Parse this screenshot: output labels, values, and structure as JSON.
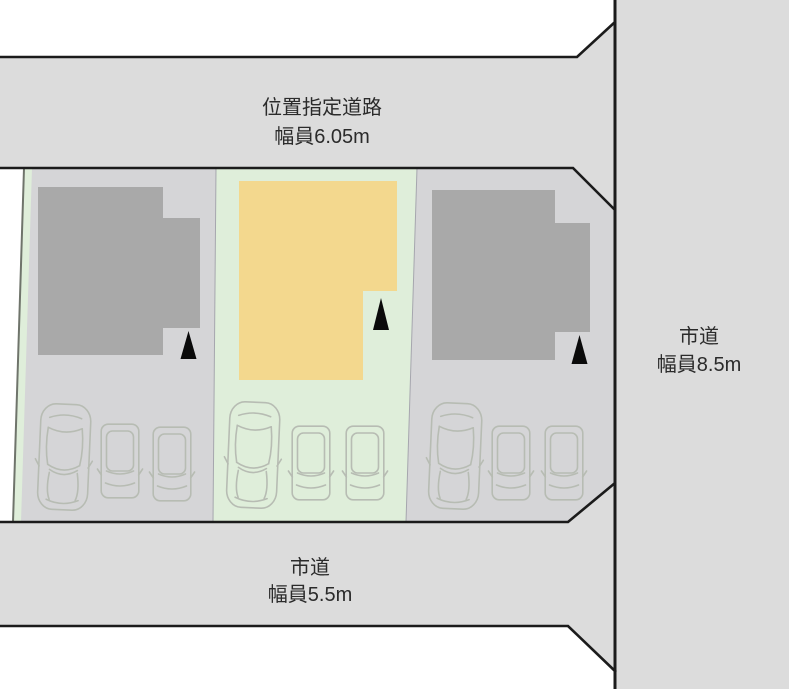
{
  "diagram": {
    "type": "residential-site-plan",
    "roads": {
      "top": {
        "name": "位置指定道路",
        "width_label": "幅員6.05m"
      },
      "right": {
        "name": "市道",
        "width_label": "幅員8.5m"
      },
      "bottom": {
        "name": "市道",
        "width_label": "幅員5.5m"
      }
    },
    "lots": {
      "count": 3,
      "subject_lot_position": "center",
      "parking_spaces_per_lot": 3,
      "entrance_markers_per_lot": 1
    },
    "icons": {
      "entrance_marker": "black-up-triangle",
      "large_car": "sedan-top-view-outline",
      "small_car": "compact-car-top-view-outline"
    },
    "colors": {
      "background": "#ffffff",
      "road": "#dcdcdc",
      "lot": "#d5d5d7",
      "subject_lot": "#dfeeda",
      "building": "#a9a9a9",
      "subject_building": "#f3d88e",
      "outline": "#1b1b1b",
      "car_outline": "#b7bcb3",
      "marker": "#0a0a0a",
      "label_text": "#2b2b2b"
    }
  }
}
